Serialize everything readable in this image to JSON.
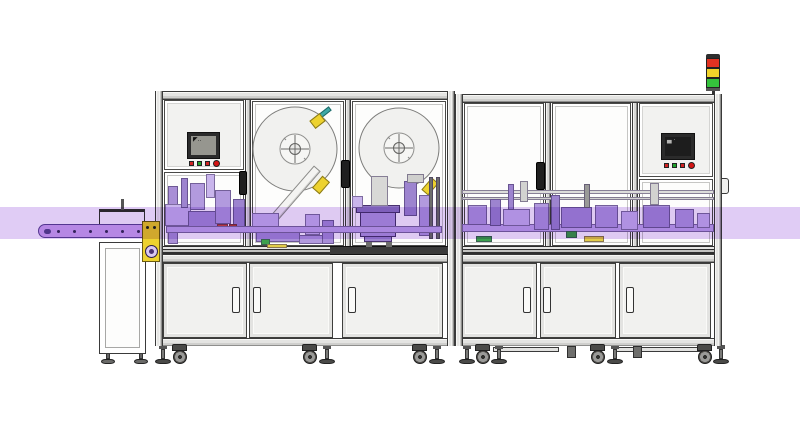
{
  "scene_description": "2D CAD elevation drawing of an automated labeling and inspection machine line: infeed belt conveyor on the left, a two-bay enclosure with two label reels and an HMI, a second enclosure with HMI and signal tower, lower cabinets with doors, casters and leveling feet. A translucent purple band highlights the product transfer level.",
  "palette": {
    "frame_line": "#3a3a3a",
    "panel_fill": "#f2f2f0",
    "window_fill": "#fdfdfc",
    "band": "#e0ccf5",
    "belt": "#cfa9ee",
    "belt_edge": "#5f4396",
    "purple_dark": "#8f76c2",
    "purple_mid": "#b29ade",
    "yellow": "#edd22f",
    "teal": "#3fa9a6",
    "red": "#cf2a2a",
    "green": "#2fae3c"
  },
  "highlight_band": {
    "color": "#e0ccf5",
    "y": 207,
    "height": 32
  },
  "conveyor": {
    "belt_color": "#cfa9ee",
    "dot_count": 6,
    "bracket_color": "#edd22f",
    "gear_color": "#8f76c2"
  },
  "left_station": {
    "hmi": {
      "bezel": "#2b2b2b",
      "screen_color": "#96968f",
      "glyph": "◤‥",
      "buttons": [
        "#cf2323",
        "#1fa32a",
        "#cf2323",
        "#d41414"
      ]
    },
    "reels": [
      {
        "cx": 295,
        "cy": 149,
        "r": 42
      },
      {
        "cx": 399,
        "cy": 148,
        "r": 40
      }
    ],
    "door_count": 3
  },
  "right_station": {
    "hmi": {
      "bezel": "#2b2b2b",
      "screen_color": "#1d1d1d",
      "glyph": "▄ ·",
      "buttons": [
        "#cf2323",
        "#1fa32a",
        "#cf2323",
        "#d41414"
      ]
    },
    "signal_tower": [
      "#e23222",
      "#f0d32a",
      "#35c23c"
    ],
    "door_count": 3
  },
  "machinery": {
    "left_blocks": [
      [
        168,
        186,
        10,
        58,
        "#a98fd6"
      ],
      [
        165,
        204,
        26,
        22,
        "#c9b5ec"
      ],
      [
        181,
        178,
        7,
        30,
        "#9d84cf"
      ],
      [
        190,
        183,
        15,
        27,
        "#b29ade"
      ],
      [
        188,
        211,
        36,
        22,
        "#a78dd8"
      ],
      [
        206,
        174,
        9,
        24,
        "#c9b5ec"
      ],
      [
        215,
        190,
        16,
        34,
        "#b29ade"
      ],
      [
        233,
        199,
        12,
        30,
        "#9d84cf"
      ],
      [
        217,
        224,
        11,
        7,
        "#cf4545"
      ],
      [
        229,
        224,
        8,
        7,
        "#b93a3a"
      ],
      [
        252,
        213,
        27,
        19,
        "#c9b5ec"
      ],
      [
        256,
        231,
        44,
        11,
        "#a78dd8"
      ],
      [
        261,
        239,
        9,
        6,
        "#3da04e"
      ],
      [
        267,
        244,
        20,
        4,
        "#e2cd49"
      ],
      [
        299,
        235,
        24,
        9,
        "#b29ade"
      ],
      [
        305,
        214,
        15,
        21,
        "#c9b5ec"
      ],
      [
        322,
        220,
        12,
        24,
        "#a78dd8"
      ],
      [
        371,
        176,
        17,
        30,
        "#d8d8d6"
      ],
      [
        352,
        196,
        11,
        12,
        "#c9b5ec"
      ],
      [
        404,
        181,
        13,
        35,
        "#9d84cf"
      ],
      [
        407,
        174,
        17,
        9,
        "#cfcfcd"
      ],
      [
        419,
        195,
        11,
        41,
        "#b29ade"
      ],
      [
        429,
        177,
        4,
        62,
        "#6e6e6c"
      ],
      [
        436,
        177,
        4,
        62,
        "#6e6e6c"
      ],
      [
        166,
        226,
        276,
        7,
        "#c2a9e8"
      ]
    ],
    "right_blocks": [
      [
        462,
        190,
        252,
        4,
        "#dddddb"
      ],
      [
        462,
        197,
        252,
        3,
        "#d2d2d0"
      ],
      [
        462,
        224,
        252,
        8,
        "#c2a9e8"
      ],
      [
        468,
        205,
        19,
        20,
        "#b29ade"
      ],
      [
        490,
        199,
        11,
        27,
        "#9d84cf"
      ],
      [
        503,
        209,
        27,
        17,
        "#c9b5ec"
      ],
      [
        508,
        184,
        6,
        26,
        "#9d84cf"
      ],
      [
        520,
        181,
        8,
        21,
        "#d2d2d0"
      ],
      [
        534,
        203,
        15,
        27,
        "#b29ade"
      ],
      [
        551,
        195,
        9,
        35,
        "#9d84cf"
      ],
      [
        561,
        207,
        31,
        21,
        "#a78dd8"
      ],
      [
        566,
        231,
        11,
        7,
        "#3da04e"
      ],
      [
        584,
        184,
        6,
        24,
        "#9a9a98"
      ],
      [
        595,
        205,
        23,
        23,
        "#b29ade"
      ],
      [
        621,
        211,
        17,
        19,
        "#c9b5ec"
      ],
      [
        643,
        205,
        27,
        23,
        "#a78dd8"
      ],
      [
        650,
        183,
        9,
        22,
        "#d2d2d0"
      ],
      [
        675,
        209,
        19,
        19,
        "#b29ade"
      ],
      [
        697,
        213,
        13,
        15,
        "#c9b5ec"
      ],
      [
        584,
        236,
        20,
        6,
        "#e2cd49"
      ],
      [
        476,
        236,
        16,
        6,
        "#3da04e"
      ]
    ]
  },
  "feet": [
    {
      "t": "tfoot",
      "x": 101,
      "y": 351
    },
    {
      "t": "tfoot",
      "x": 134,
      "y": 351
    },
    {
      "t": "lfoot",
      "x": 155,
      "y": 345
    },
    {
      "t": "caster",
      "x": 171,
      "y": 344
    },
    {
      "t": "caster",
      "x": 301,
      "y": 344
    },
    {
      "t": "lfoot",
      "x": 319,
      "y": 345
    },
    {
      "t": "caster",
      "x": 411,
      "y": 344
    },
    {
      "t": "lfoot",
      "x": 429,
      "y": 345
    },
    {
      "t": "lfoot",
      "x": 459,
      "y": 345
    },
    {
      "t": "caster",
      "x": 474,
      "y": 344
    },
    {
      "t": "lfoot",
      "x": 491,
      "y": 345
    },
    {
      "t": "rail",
      "x": 493,
      "y": 347,
      "w": 66
    },
    {
      "t": "stub",
      "x": 567,
      "y": 346
    },
    {
      "t": "caster",
      "x": 589,
      "y": 344
    },
    {
      "t": "lfoot",
      "x": 607,
      "y": 345
    },
    {
      "t": "rail",
      "x": 616,
      "y": 347,
      "w": 86
    },
    {
      "t": "stub",
      "x": 633,
      "y": 346
    },
    {
      "t": "caster",
      "x": 696,
      "y": 344
    },
    {
      "t": "lfoot",
      "x": 713,
      "y": 345
    }
  ]
}
